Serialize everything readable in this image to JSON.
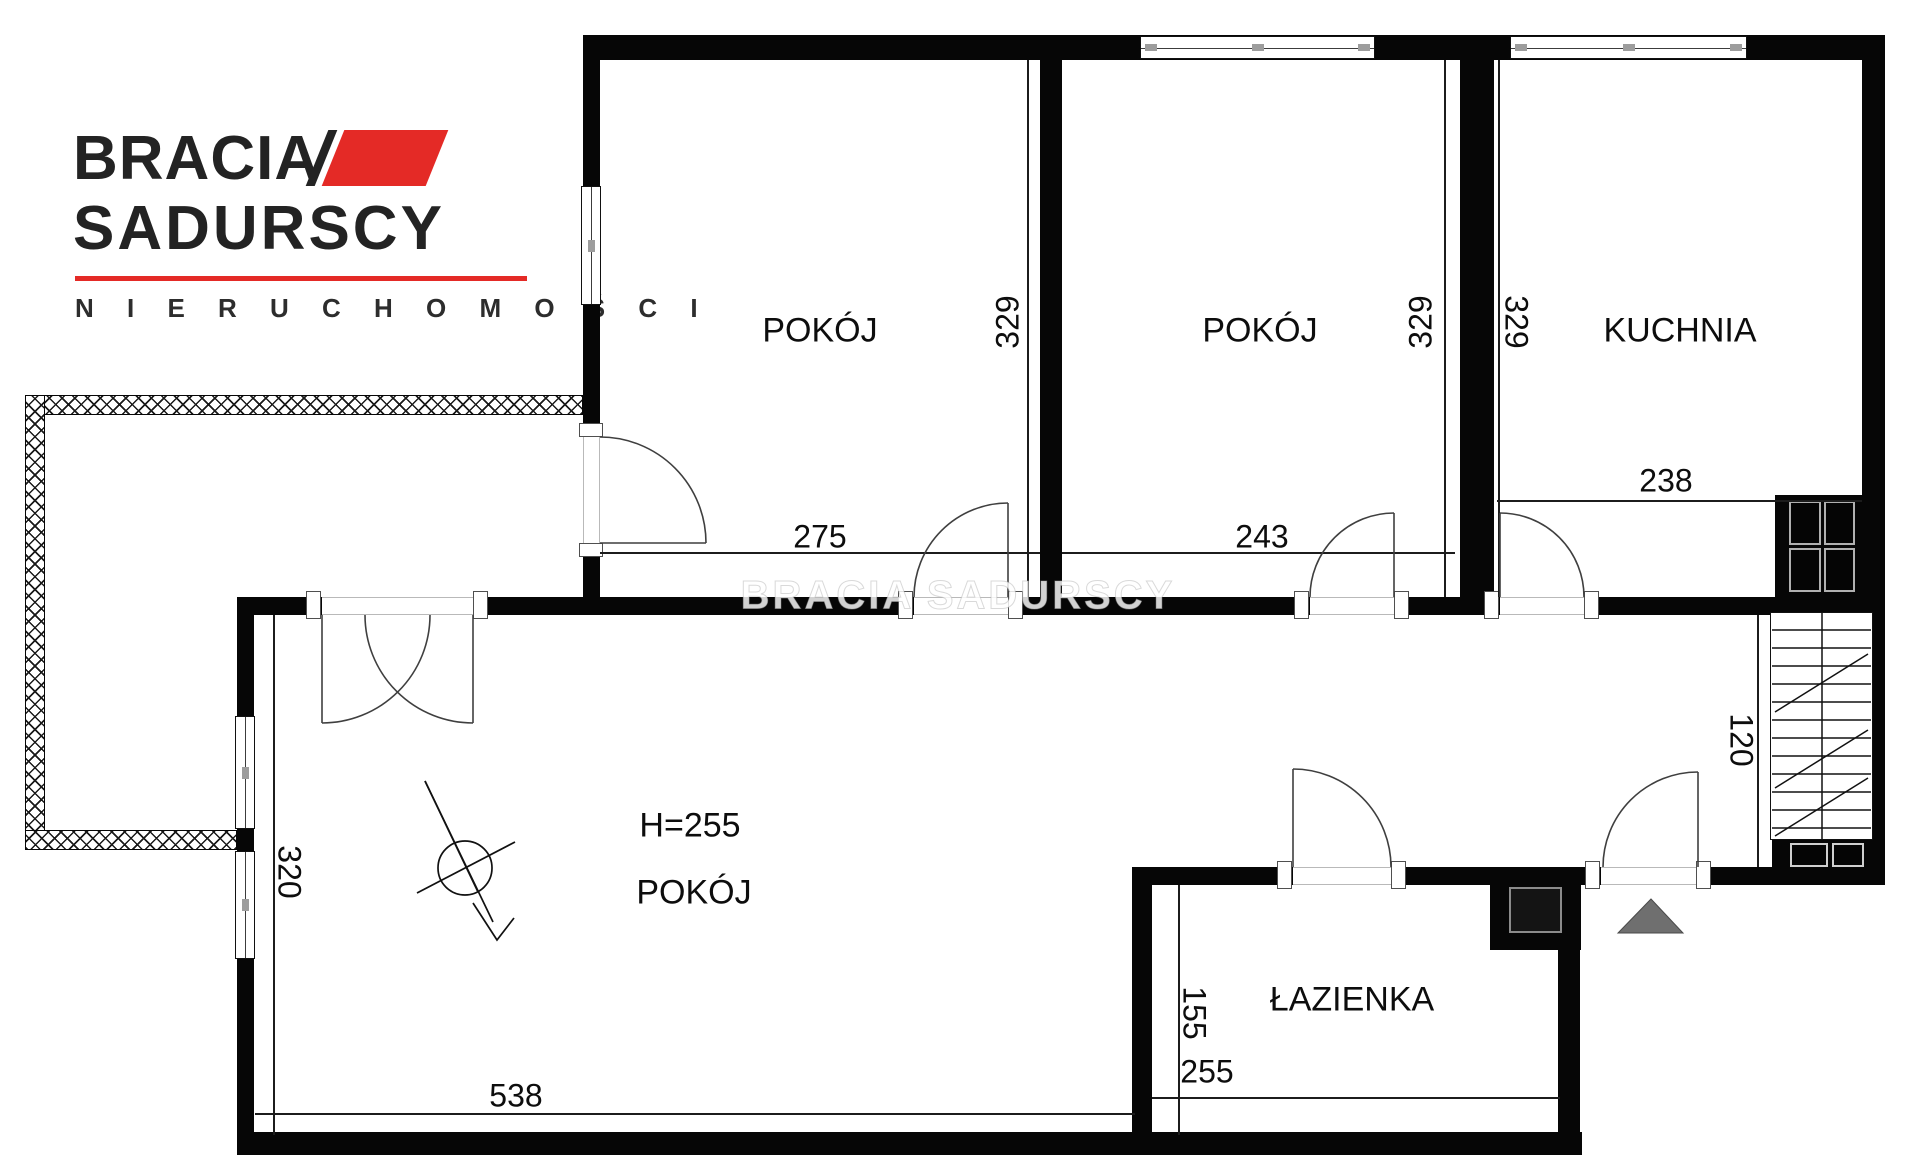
{
  "brand": {
    "line1": "BRACIA",
    "line2": "SADURSCY",
    "tagline": "N I E R U C H O M O Ś C I",
    "accent_color": "#e42a26",
    "text_color": "#232323"
  },
  "watermark": {
    "text": "BRACIA SADURSCY"
  },
  "plan": {
    "wall_color": "#060606",
    "rooms": {
      "room1": {
        "label": "POKÓJ"
      },
      "room2": {
        "label": "POKÓJ"
      },
      "kitchen": {
        "label": "KUCHNIA"
      },
      "living": {
        "label": "POKÓJ",
        "height_note": "H=255"
      },
      "bathroom": {
        "label": "ŁAZIENKA"
      }
    },
    "dimensions": {
      "room1_width": "275",
      "room1_depth": "329",
      "room2_width": "243",
      "room2_depth": "329",
      "kitchen_width": "238",
      "kitchen_depth": "329",
      "living_width": "538",
      "living_depth": "320",
      "bathroom_width": "255",
      "bathroom_depth": "155",
      "hall_width": "120"
    },
    "symbols": {
      "north_arrow": "compass-north-arrow",
      "entrance_marker": "entrance-triangle",
      "stairs": "staircase",
      "balcony_rail": "cross-hatched-railing"
    }
  }
}
